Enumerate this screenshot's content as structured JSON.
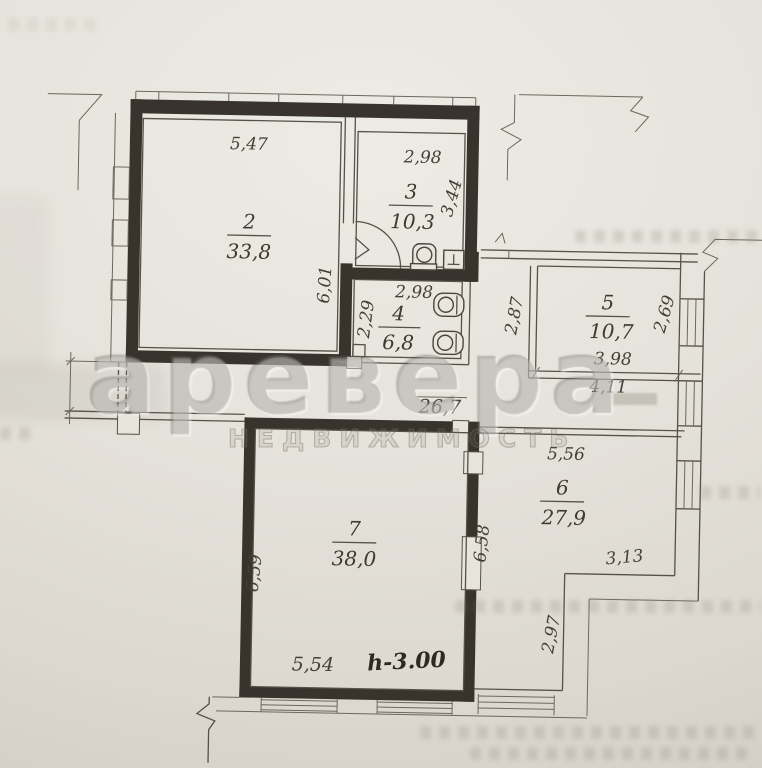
{
  "watermark": {
    "brand": "аревера",
    "subtitle": "НЕДВИЖИМОСТЬ"
  },
  "rooms": [
    {
      "number": "2",
      "area": "33,8"
    },
    {
      "number": "3",
      "area": "10,3"
    },
    {
      "number": "4",
      "area": "6,8"
    },
    {
      "number": "5",
      "area": "10,7"
    },
    {
      "number": "6",
      "area": "27,9"
    },
    {
      "number": "7",
      "area": "38,0"
    }
  ],
  "dims": {
    "r2_top": "5,47",
    "r2_right": "6,01",
    "r3_top": "2,98",
    "r3_right": "3,44",
    "r4_top": "2,98",
    "r4_left": "2,29",
    "hall_height": "2,87",
    "r5_right": "2,69",
    "r5_bottom_inner": "3,98",
    "r5_bottom_outer": "4,11",
    "corridor_total": "26,7",
    "r6_top": "5,56",
    "r6_left": "6,58",
    "r6_step": "3,13",
    "r6_lower": "2,97",
    "r7_left": "6,59",
    "r7_bottom": "5,54"
  },
  "annotations": {
    "ceiling_height": "h-3.00"
  }
}
